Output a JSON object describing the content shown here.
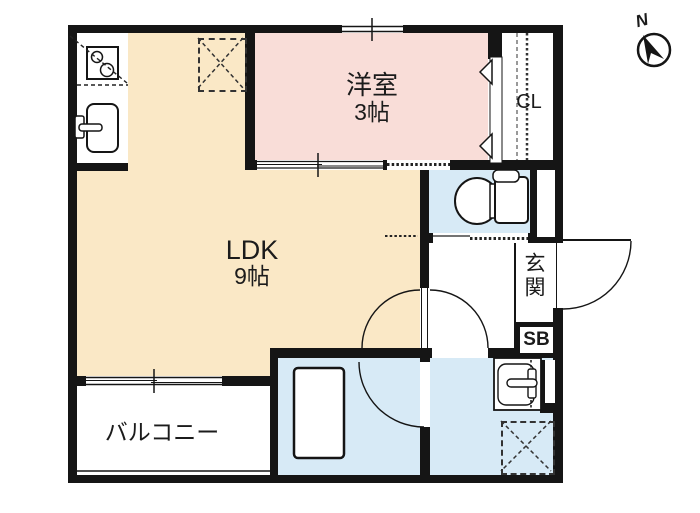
{
  "compass": {
    "label": "N"
  },
  "rooms": {
    "ldk": {
      "name": "LDK",
      "size": "9帖"
    },
    "western": {
      "name": "洋室",
      "size": "3帖"
    },
    "balcony": {
      "name": "バルコニー"
    },
    "entrance": {
      "name": "玄関"
    },
    "closet": {
      "name": "CL"
    },
    "shoebox": {
      "name": "SB"
    }
  },
  "fixtures": [
    "gas-stove",
    "kitchen-sink",
    "refrigerator-space",
    "closet-hanger-rail",
    "toilet",
    "bathtub",
    "washbasin",
    "washing-machine-space"
  ],
  "colors": {
    "ldk_fill": "#fae8c6",
    "western_fill": "#f9ddd8",
    "wet_area_fill": "#d7eaf6",
    "wall": "#151515"
  }
}
